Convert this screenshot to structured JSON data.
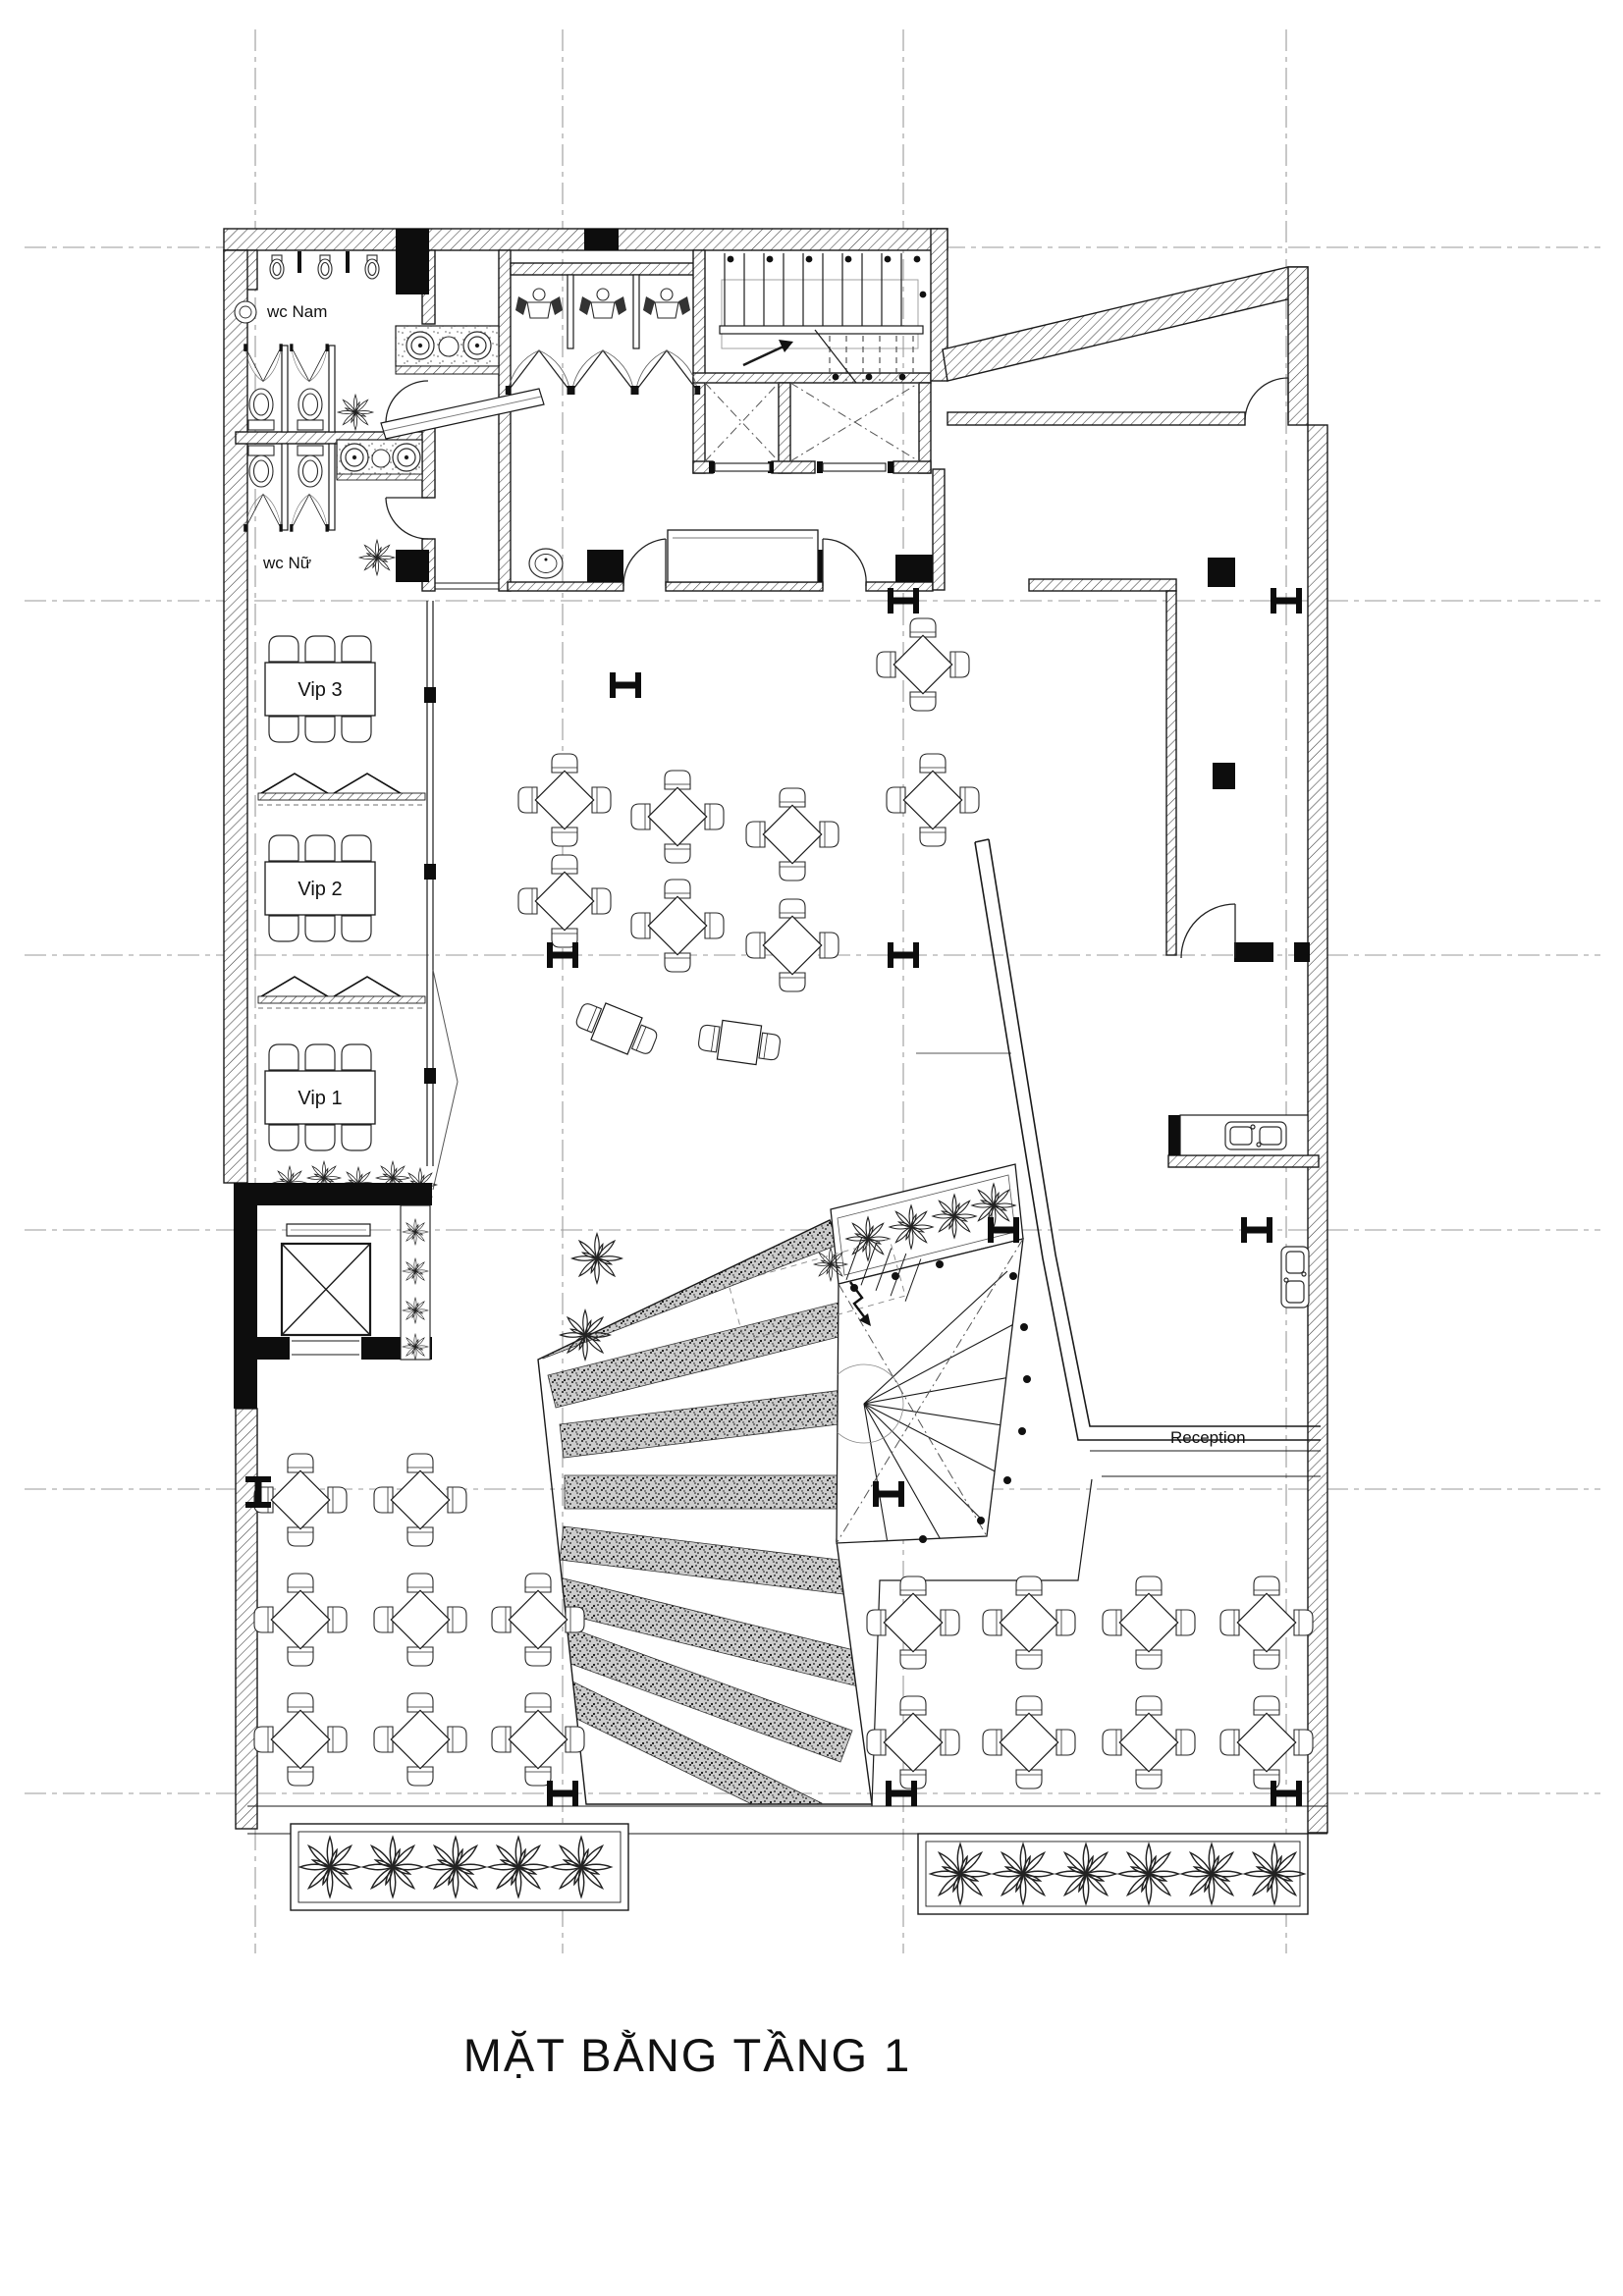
{
  "title": "MẶT BẰNG TẦNG 1",
  "labels": {
    "wc_nam": "wc Nam",
    "wc_nu": "wc Nữ",
    "vip3": "Vip 3",
    "vip2": "Vip 2",
    "vip1": "Vip 1",
    "reception": "Reception"
  },
  "colors": {
    "paper": "#ffffff",
    "line": "#1a1a1a",
    "grid": "#9a9a9a",
    "solid_fill": "#0d0d0d"
  }
}
